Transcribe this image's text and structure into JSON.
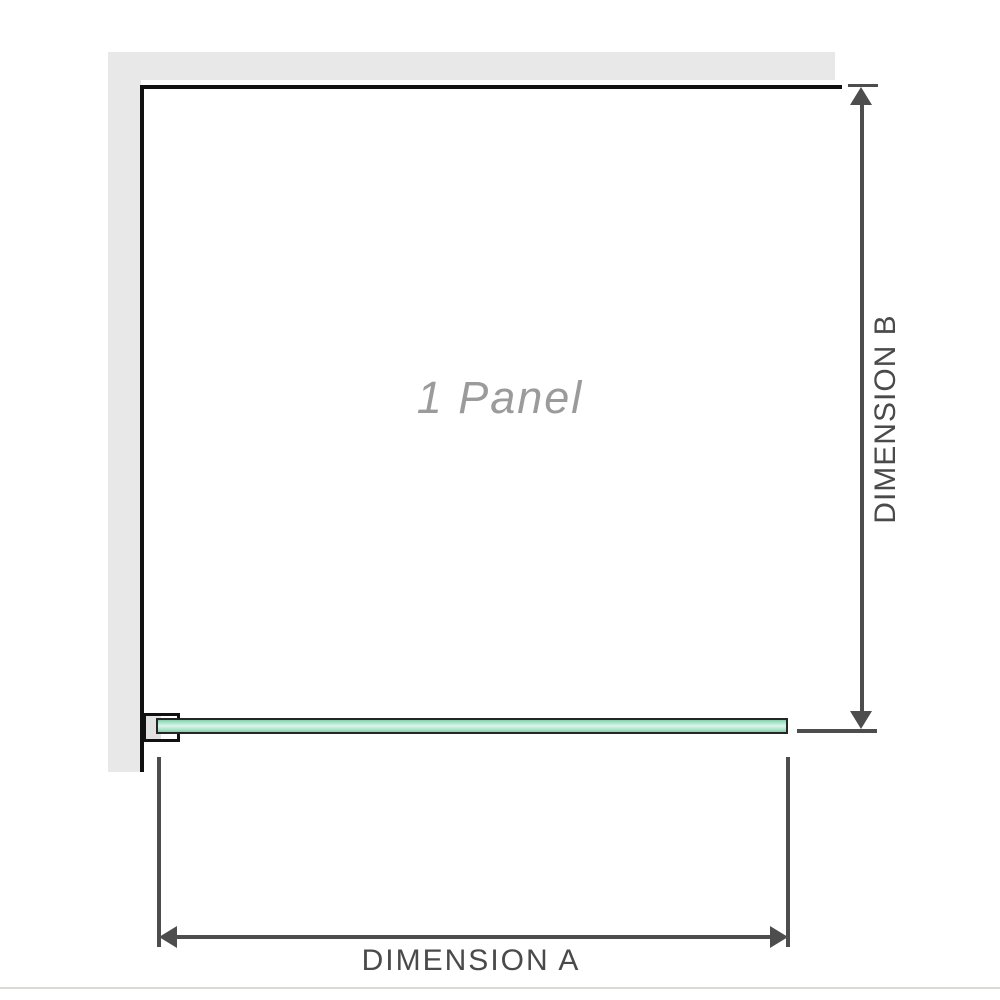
{
  "diagram": {
    "panel_label": "1 Panel",
    "dimension_a_label": "DIMENSION A",
    "dimension_b_label": "DIMENSION B"
  },
  "colors": {
    "wall": "#e8e8e8",
    "panel_outline": "#111111",
    "dimension": "#4d4d4d",
    "dimension_text": "#4a4a4a",
    "panel_label_text": "#9b9b9b",
    "glass_light": "#dcf4e8",
    "glass_mid": "#a9e2c8",
    "glass_edge": "#7fcfa9",
    "glass_border": "#262626",
    "bracket_fill": "#ffffff",
    "bracket_inner": "#e2e2e2",
    "baseline": "#dbdbd4"
  }
}
